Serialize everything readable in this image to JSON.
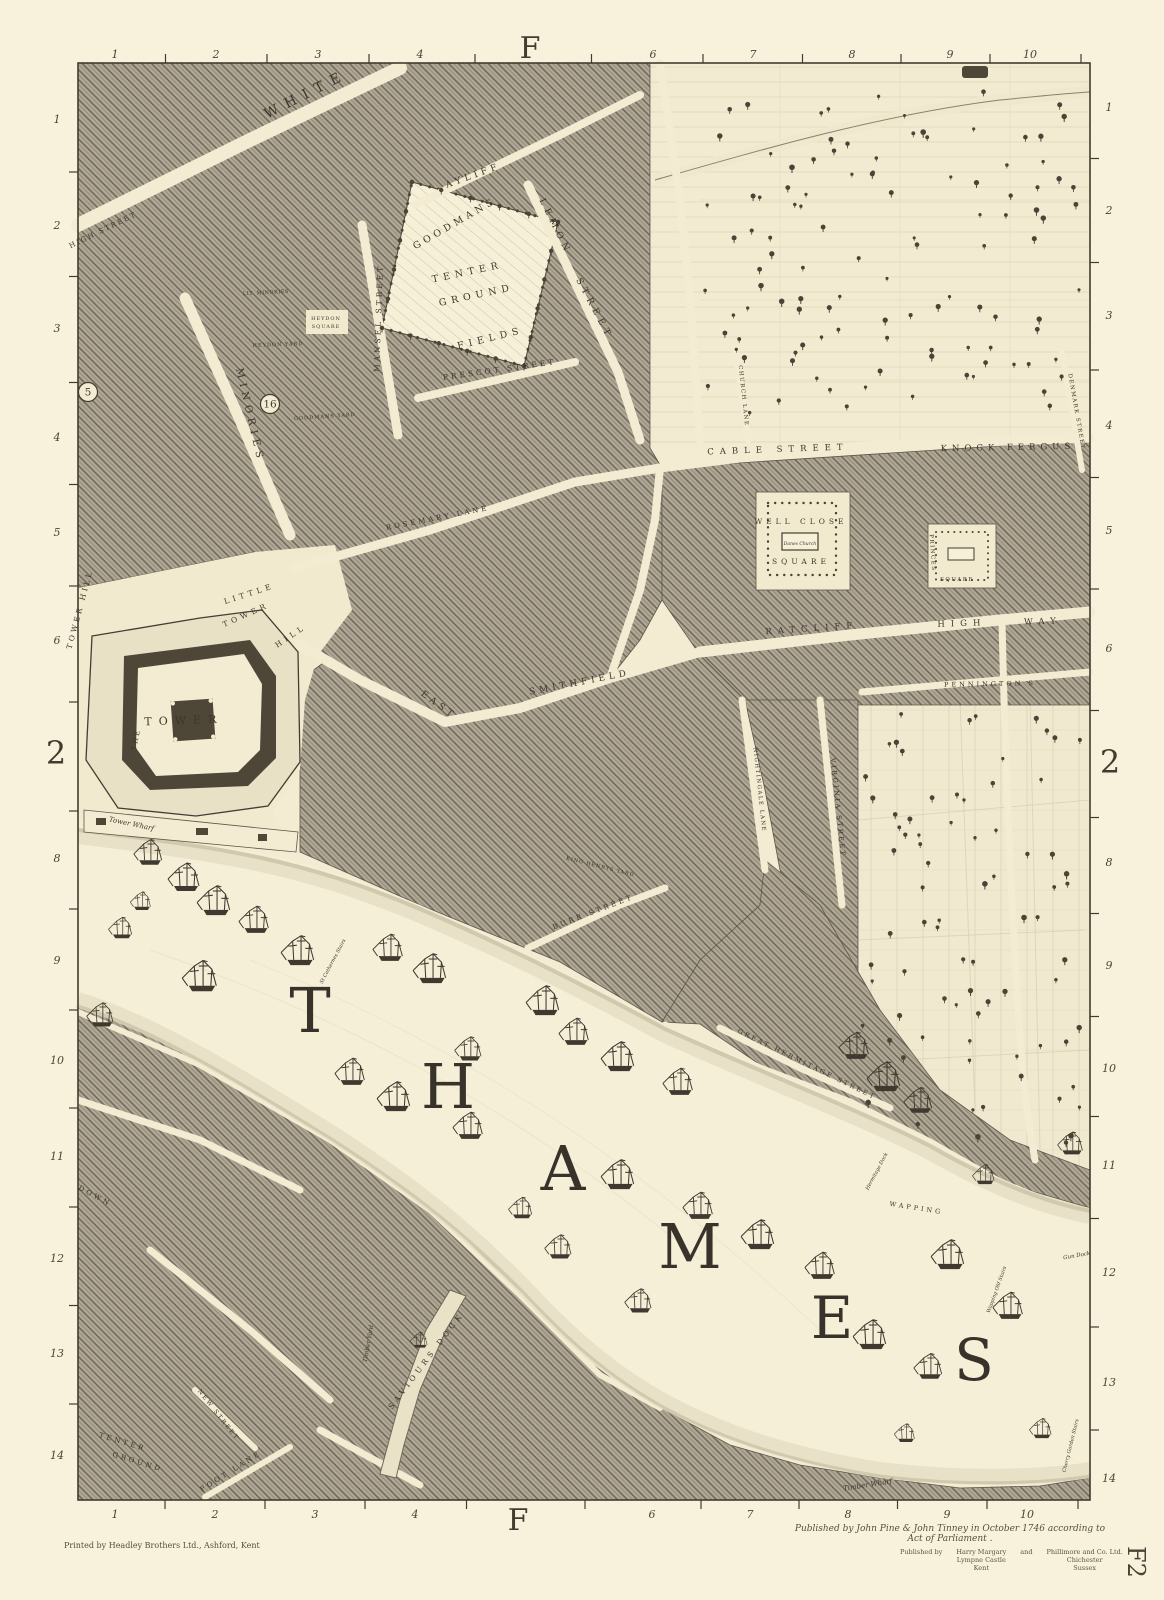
{
  "sheet": {
    "column_letter": "F",
    "row_number": "2",
    "plate": "F2"
  },
  "border": {
    "top_letter": {
      "t": "F",
      "x": 530,
      "y": 58
    },
    "bottom_letter": {
      "t": "F",
      "x": 518,
      "y": 1530
    },
    "left_row": {
      "t": "2",
      "x": 56,
      "y": 764
    },
    "right_row": {
      "t": "2",
      "x": 1110,
      "y": 773
    },
    "top_numbers": [
      {
        "t": "1",
        "x": 115
      },
      {
        "t": "2",
        "x": 216
      },
      {
        "t": "3",
        "x": 318
      },
      {
        "t": "4",
        "x": 420
      },
      {
        "t": "6",
        "x": 653
      },
      {
        "t": "7",
        "x": 753
      },
      {
        "t": "8",
        "x": 852
      },
      {
        "t": "9",
        "x": 950
      },
      {
        "t": "10",
        "x": 1030
      }
    ],
    "bottom_numbers": [
      {
        "t": "1",
        "x": 115
      },
      {
        "t": "2",
        "x": 215
      },
      {
        "t": "3",
        "x": 315
      },
      {
        "t": "4",
        "x": 415
      },
      {
        "t": "6",
        "x": 652
      },
      {
        "t": "7",
        "x": 750
      },
      {
        "t": "8",
        "x": 848
      },
      {
        "t": "9",
        "x": 947
      },
      {
        "t": "10",
        "x": 1027
      }
    ],
    "left_numbers": [
      {
        "t": "1",
        "y": 119
      },
      {
        "t": "2",
        "y": 225
      },
      {
        "t": "3",
        "y": 328
      },
      {
        "t": "4",
        "y": 437
      },
      {
        "t": "5",
        "y": 532
      },
      {
        "t": "6",
        "y": 640
      },
      {
        "t": "8",
        "y": 858
      },
      {
        "t": "9",
        "y": 960
      },
      {
        "t": "10",
        "y": 1060
      },
      {
        "t": "11",
        "y": 1156
      },
      {
        "t": "12",
        "y": 1258
      },
      {
        "t": "13",
        "y": 1353
      },
      {
        "t": "14",
        "y": 1455
      }
    ],
    "right_numbers": [
      {
        "t": "1",
        "y": 107
      },
      {
        "t": "2",
        "y": 210
      },
      {
        "t": "3",
        "y": 315
      },
      {
        "t": "4",
        "y": 425
      },
      {
        "t": "5",
        "y": 530
      },
      {
        "t": "6",
        "y": 648
      },
      {
        "t": "8",
        "y": 862
      },
      {
        "t": "9",
        "y": 965
      },
      {
        "t": "10",
        "y": 1068
      },
      {
        "t": "11",
        "y": 1165
      },
      {
        "t": "12",
        "y": 1272
      },
      {
        "t": "13",
        "y": 1382
      },
      {
        "t": "14",
        "y": 1478
      }
    ]
  },
  "imprints": {
    "printer": "Printed by Headley Brothers Ltd., Ashford, Kent",
    "publication": "Published by John Pine & John Tinney in October 1746 according to Act of Parliament .",
    "publisher_label": "Published by",
    "publisher_1": "Harry Margary\nLympne Castle\nKent",
    "publisher_conj": "and",
    "publisher_2": "Phillimore and Co. Ltd.\nChichester\nSussex",
    "plate_ref": "F2"
  },
  "map": {
    "river_name": "THAMES",
    "thames_letters": [
      {
        "t": "T",
        "x": 310,
        "y": 1032,
        "s": 62
      },
      {
        "t": "H",
        "x": 448,
        "y": 1108,
        "s": 62
      },
      {
        "t": "A",
        "x": 563,
        "y": 1190,
        "s": 62
      },
      {
        "t": "M",
        "x": 690,
        "y": 1268,
        "s": 62
      },
      {
        "t": "E",
        "x": 832,
        "y": 1338,
        "s": 58
      },
      {
        "t": "S",
        "x": 974,
        "y": 1380,
        "s": 58
      }
    ],
    "labels": [
      {
        "t": "WHITE",
        "x": 308,
        "y": 98,
        "r": -27,
        "s": 14,
        "ls": 8
      },
      {
        "t": "HIGH STREET",
        "x": 104,
        "y": 232,
        "r": -26,
        "s": 7,
        "ls": 2
      },
      {
        "t": "AYLIFF",
        "x": 474,
        "y": 178,
        "r": -20,
        "s": 9,
        "ls": 4
      },
      {
        "t": "LEMON",
        "x": 553,
        "y": 228,
        "r": 64,
        "s": 9,
        "ls": 5
      },
      {
        "t": "STREET",
        "x": 592,
        "y": 310,
        "r": 62,
        "s": 9,
        "ls": 5
      },
      {
        "t": "MANSEL STREET",
        "x": 381,
        "y": 318,
        "r": -88,
        "s": 7.5,
        "ls": 3
      },
      {
        "t": "MINORIES",
        "x": 247,
        "y": 416,
        "r": 77,
        "s": 10,
        "ls": 5
      },
      {
        "t": "LIT. MINORIES",
        "x": 266,
        "y": 294,
        "r": -3,
        "s": 5,
        "ls": 0.5
      },
      {
        "t": "GOODMANS",
        "x": 456,
        "y": 226,
        "r": -30,
        "s": 9.5,
        "ls": 4
      },
      {
        "t": "TENTER",
        "x": 468,
        "y": 275,
        "r": -12,
        "s": 9.5,
        "ls": 5
      },
      {
        "t": "GROUND",
        "x": 477,
        "y": 298,
        "r": -12,
        "s": 9.5,
        "ls": 5
      },
      {
        "t": "FIELDS",
        "x": 491,
        "y": 341,
        "r": -14,
        "s": 9.5,
        "ls": 5
      },
      {
        "t": "PRESCOT STREET",
        "x": 500,
        "y": 372,
        "r": -8,
        "s": 7.5,
        "ls": 3
      },
      {
        "t": "HEYDON",
        "x": 326,
        "y": 320,
        "r": 0,
        "s": 5,
        "ls": 1
      },
      {
        "t": "SQUARE",
        "x": 326,
        "y": 328,
        "r": 0,
        "s": 5,
        "ls": 1
      },
      {
        "t": "HEYDON YARD",
        "x": 278,
        "y": 346,
        "r": -2,
        "s": 5,
        "ls": 1
      },
      {
        "t": "GOODMANS YARD",
        "x": 325,
        "y": 418,
        "r": -4,
        "s": 5,
        "ls": 1
      },
      {
        "t": "ROSEMARY LANE",
        "x": 438,
        "y": 520,
        "r": -11,
        "s": 7,
        "ls": 3
      },
      {
        "t": "CABLE STREET",
        "x": 778,
        "y": 452,
        "r": -2,
        "s": 8.5,
        "ls": 6
      },
      {
        "t": "KNOCK FERGUS",
        "x": 1008,
        "y": 450,
        "r": -1,
        "s": 8.5,
        "ls": 5
      },
      {
        "t": "CHURCH LANE",
        "x": 742,
        "y": 396,
        "r": 84,
        "s": 5.5,
        "ls": 1.5
      },
      {
        "t": "DENMARK STREET",
        "x": 1075,
        "y": 412,
        "r": 80,
        "s": 5.5,
        "ls": 1.5
      },
      {
        "t": "WELL CLOSE",
        "x": 801,
        "y": 524,
        "r": 0,
        "s": 7.5,
        "ls": 4
      },
      {
        "t": "SQUARE",
        "x": 801,
        "y": 564,
        "r": 0,
        "s": 7.5,
        "ls": 4
      },
      {
        "t": "PRINCES",
        "x": 931,
        "y": 553,
        "r": 86,
        "s": 5.5,
        "ls": 1.5
      },
      {
        "t": "SQUARE",
        "x": 957,
        "y": 581,
        "r": 0,
        "s": 5.5,
        "ls": 1.5
      },
      {
        "t": "RATCLIFF",
        "x": 812,
        "y": 631,
        "r": -4,
        "s": 8.5,
        "ls": 6
      },
      {
        "t": "HIGH",
        "x": 962,
        "y": 626,
        "r": -2,
        "s": 8.5,
        "ls": 6
      },
      {
        "t": "WAY",
        "x": 1043,
        "y": 624,
        "r": -2,
        "s": 8.5,
        "ls": 6
      },
      {
        "t": "PENNINGTON S",
        "x": 990,
        "y": 686,
        "r": -1,
        "s": 6.5,
        "ls": 3
      },
      {
        "t": "EAST",
        "x": 437,
        "y": 707,
        "r": 36,
        "s": 9,
        "ls": 4
      },
      {
        "t": "SMITHFIELD",
        "x": 580,
        "y": 685,
        "r": -11,
        "s": 9,
        "ls": 4
      },
      {
        "t": "TOWER HILL",
        "x": 82,
        "y": 610,
        "r": -75,
        "s": 7.5,
        "ls": 3
      },
      {
        "t": "LITTLE",
        "x": 250,
        "y": 596,
        "r": -18,
        "s": 7.5,
        "ls": 4
      },
      {
        "t": "TOWER",
        "x": 247,
        "y": 617,
        "r": -24,
        "s": 7.5,
        "ls": 4
      },
      {
        "t": "HILL",
        "x": 292,
        "y": 638,
        "r": -34,
        "s": 7.5,
        "ls": 4
      },
      {
        "t": "THE",
        "x": 138,
        "y": 740,
        "r": -78,
        "s": 7,
        "ls": 2
      },
      {
        "t": "TOWER",
        "x": 184,
        "y": 724,
        "r": -2,
        "s": 11,
        "ls": 7
      },
      {
        "t": "NIGHTINGALE LANE",
        "x": 758,
        "y": 790,
        "r": 84,
        "s": 5.5,
        "ls": 1.5
      },
      {
        "t": "VIRGINIA STREET",
        "x": 836,
        "y": 808,
        "r": 84,
        "s": 6.5,
        "ls": 2.5
      },
      {
        "t": "BURR STREET",
        "x": 594,
        "y": 914,
        "r": -21,
        "s": 7,
        "ls": 3
      },
      {
        "t": "KING HENRYS YARD",
        "x": 600,
        "y": 868,
        "r": 14,
        "s": 5,
        "ls": 1
      },
      {
        "t": "GREAT HERMITAGE STREET",
        "x": 806,
        "y": 1066,
        "r": 26,
        "s": 6.5,
        "ls": 2.5
      },
      {
        "t": "WAPPING",
        "x": 916,
        "y": 1210,
        "r": 9,
        "s": 6.5,
        "ls": 3
      },
      {
        "t": "SAVIOURS DOCK",
        "x": 428,
        "y": 1362,
        "r": -53,
        "s": 7.5,
        "ls": 4
      },
      {
        "t": "TENTER",
        "x": 122,
        "y": 1444,
        "r": 17,
        "s": 7,
        "ls": 3
      },
      {
        "t": "GROUND",
        "x": 137,
        "y": 1464,
        "r": 17,
        "s": 7,
        "ls": 3
      },
      {
        "t": "NEW STREET",
        "x": 217,
        "y": 1416,
        "r": 52,
        "s": 6,
        "ls": 2
      },
      {
        "t": "FOOT LANE",
        "x": 232,
        "y": 1473,
        "r": -32,
        "s": 7,
        "ls": 3
      },
      {
        "t": "DOWN",
        "x": 94,
        "y": 1198,
        "r": 28,
        "s": 7,
        "ls": 3
      },
      {
        "t": "Tower Wharf",
        "x": 131,
        "y": 826,
        "r": 12,
        "s": 7,
        "k": "cursive"
      },
      {
        "t": "Timber Wharf",
        "x": 868,
        "y": 1487,
        "r": -9,
        "s": 7,
        "k": "cursive"
      },
      {
        "t": "Gun Dock",
        "x": 1077,
        "y": 1257,
        "r": -10,
        "s": 5.5,
        "k": "cursive"
      },
      {
        "t": "Wapping Old Stairs",
        "x": 998,
        "y": 1290,
        "r": -70,
        "s": 5,
        "k": "cursive"
      },
      {
        "t": "Cherry Garden Stairs",
        "x": 1072,
        "y": 1446,
        "r": -76,
        "s": 5,
        "k": "cursive"
      },
      {
        "t": "St Cathernes Stairs",
        "x": 334,
        "y": 962,
        "r": -62,
        "s": 5,
        "k": "cursive"
      },
      {
        "t": "Hermitage Dock",
        "x": 878,
        "y": 1172,
        "r": -62,
        "s": 5,
        "k": "cursive"
      },
      {
        "t": "Timber Yard",
        "x": 370,
        "y": 1344,
        "r": -80,
        "s": 6,
        "k": "cursive"
      },
      {
        "t": "Danes Church",
        "x": 800,
        "y": 545,
        "r": 0,
        "s": 4.5,
        "k": "cursive"
      }
    ],
    "circled_numbers": [
      {
        "t": "16",
        "x": 270,
        "y": 404
      },
      {
        "t": "5",
        "x": 88,
        "y": 392
      }
    ],
    "ships": [
      [
        150,
        862,
        0.9
      ],
      [
        186,
        888,
        1
      ],
      [
        216,
        912,
        1.05
      ],
      [
        122,
        936,
        0.75
      ],
      [
        256,
        930,
        0.95
      ],
      [
        300,
        962,
        1.05
      ],
      [
        202,
        988,
        1.1
      ],
      [
        102,
        1024,
        0.85
      ],
      [
        390,
        958,
        0.95
      ],
      [
        432,
        980,
        1.05
      ],
      [
        545,
        1012,
        1.05
      ],
      [
        576,
        1042,
        0.95
      ],
      [
        470,
        1058,
        0.85
      ],
      [
        620,
        1068,
        1.05
      ],
      [
        680,
        1092,
        0.95
      ],
      [
        856,
        1056,
        0.95
      ],
      [
        886,
        1088,
        1.05
      ],
      [
        920,
        1110,
        0.9
      ],
      [
        352,
        1082,
        0.95
      ],
      [
        396,
        1108,
        1.05
      ],
      [
        470,
        1136,
        0.95
      ],
      [
        620,
        1186,
        1.05
      ],
      [
        700,
        1216,
        0.95
      ],
      [
        760,
        1246,
        1.05
      ],
      [
        822,
        1276,
        0.95
      ],
      [
        950,
        1266,
        1.05
      ],
      [
        1010,
        1316,
        0.95
      ],
      [
        872,
        1346,
        1.05
      ],
      [
        930,
        1376,
        0.9
      ],
      [
        560,
        1256,
        0.85
      ],
      [
        522,
        1216,
        0.75
      ],
      [
        640,
        1310,
        0.85
      ],
      [
        1042,
        1436,
        0.7
      ],
      [
        1072,
        1152,
        0.8
      ],
      [
        142,
        908,
        0.65
      ],
      [
        906,
        1440,
        0.65
      ],
      [
        420,
        1346,
        0.55
      ],
      [
        985,
        1182,
        0.7
      ]
    ]
  },
  "colors": {
    "paper": "#f8f2dc",
    "map_paper": "#f3ecd2",
    "ink": "#423c30",
    "urban_block": "#b2aa97",
    "open_ground": "#f1eace",
    "water": "#f5efd8"
  }
}
